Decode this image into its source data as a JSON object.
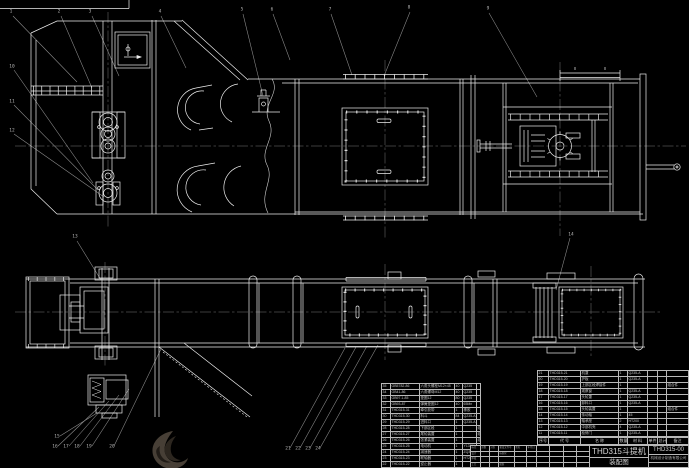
{
  "meta": {
    "background": "#000000",
    "line_color": "#ededed",
    "leader_color": "#8f8f8f",
    "table_line_color": "#b9b9b9",
    "text_color": "#c4c4c4",
    "watermark_color": "#473f36"
  },
  "title_block": {
    "product_title": "THD315斗提机",
    "drawing_type": "装配图",
    "drawing_no": "THD315-00",
    "company": "机械设计制造有限公司",
    "revision_grid": [
      [
        "标记",
        "处数",
        "分区",
        "更改文件号",
        "签名",
        "年月日"
      ],
      [
        "设计",
        "",
        "",
        "标准化",
        "",
        ""
      ],
      [
        "审核",
        "",
        "",
        "",
        "",
        ""
      ],
      [
        "工艺",
        "",
        "",
        "批准",
        "",
        ""
      ]
    ],
    "stage_grid": [
      [
        "",
        "",
        "",
        ""
      ],
      [
        "",
        "",
        "",
        ""
      ],
      [
        "",
        "",
        "",
        ""
      ],
      [
        "",
        "",
        "",
        ""
      ]
    ]
  },
  "bom_right": {
    "header": [
      "序号",
      "代 号",
      "名 称",
      "数量",
      "材 料",
      "单件",
      "总计",
      "备注"
    ],
    "rows": [
      [
        "21",
        "THD315-21",
        "机罩",
        "1",
        "Q235-A",
        "",
        "",
        ""
      ],
      [
        "20",
        "THD315-20",
        "护板",
        "1",
        "Q235-A",
        "",
        "",
        ""
      ],
      [
        "19",
        "THD315-19",
        "上部区段焊接件",
        "1",
        "",
        "",
        "",
        "组合件"
      ],
      [
        "18",
        "THD315-18",
        "观察窗",
        "1",
        "Q235-A",
        "",
        "",
        ""
      ],
      [
        "17",
        "THD315-17",
        "头轮罩",
        "1",
        "Q235-A",
        "",
        "",
        ""
      ],
      [
        "16",
        "THD315-16",
        "卸料口",
        "1",
        "Q235-A",
        "",
        "",
        ""
      ],
      [
        "15",
        "THD315-15",
        "头轮装置",
        "1",
        "",
        "",
        "",
        "组合件"
      ],
      [
        "14",
        "THD315-14",
        "传动轴",
        "1",
        "45",
        "",
        "",
        ""
      ],
      [
        "13",
        "THD315-13",
        "轴承座",
        "2",
        "HT200",
        "",
        "",
        ""
      ],
      [
        "12",
        "THD315-12",
        "中部机壳",
        "4",
        "Q235-A",
        "",
        "",
        ""
      ],
      [
        "11",
        "THD315-11",
        "检修门",
        "1",
        "Q235-A",
        "",
        "",
        ""
      ]
    ]
  },
  "bom_left": {
    "rows": [
      [
        "35",
        "GB5782-86",
        "六角头螺栓M12×45",
        "40",
        "Q235",
        ""
      ],
      [
        "34",
        "GB41-86",
        "六角螺母M12",
        "40",
        "Q235",
        ""
      ],
      [
        "33",
        "GB97.1-85",
        "垫圈12",
        "80",
        "Q235",
        ""
      ],
      [
        "32",
        "GB93-87",
        "弹簧垫圈12",
        "40",
        "65Mn",
        ""
      ],
      [
        "31",
        "THD315-31",
        "牵引胶带",
        "1",
        "橡胶",
        ""
      ],
      [
        "30",
        "THD315-30",
        "料斗",
        "84",
        "Q235-A",
        ""
      ],
      [
        "29",
        "THD315-29",
        "进料口",
        "1",
        "Q235-A",
        ""
      ],
      [
        "28",
        "THD315-28",
        "下部区段",
        "1",
        "",
        "组合件"
      ],
      [
        "27",
        "THD315-27",
        "尾轮装置",
        "1",
        "",
        "组合件"
      ],
      [
        "26",
        "THD315-26",
        "张紧装置",
        "1",
        "",
        "组合件"
      ],
      [
        "25",
        "THD315-25",
        "电动机",
        "1",
        "Y132M-4",
        ""
      ],
      [
        "24",
        "THD315-24",
        "减速器",
        "1",
        "ZQ350",
        ""
      ],
      [
        "23",
        "THD315-23",
        "联轴器",
        "1",
        "HT200",
        ""
      ],
      [
        "22",
        "THD315-22",
        "逆止器",
        "1",
        "",
        ""
      ]
    ]
  },
  "callouts": [
    {
      "x": 11,
      "y": 13,
      "label": "1"
    },
    {
      "x": 59,
      "y": 13,
      "label": "2"
    },
    {
      "x": 90,
      "y": 13,
      "label": "3"
    },
    {
      "x": 160,
      "y": 13,
      "label": "4"
    },
    {
      "x": 242,
      "y": 11,
      "label": "5"
    },
    {
      "x": 272,
      "y": 11,
      "label": "6"
    },
    {
      "x": 330,
      "y": 11,
      "label": "7"
    },
    {
      "x": 409,
      "y": 9,
      "label": "8"
    },
    {
      "x": 488,
      "y": 10,
      "label": "9"
    },
    {
      "x": 12,
      "y": 68,
      "label": "10"
    },
    {
      "x": 12,
      "y": 103,
      "label": "11"
    },
    {
      "x": 12,
      "y": 132,
      "label": "12"
    },
    {
      "x": 75,
      "y": 238,
      "label": "13"
    },
    {
      "x": 571,
      "y": 236,
      "label": "14"
    },
    {
      "x": 57,
      "y": 438,
      "label": "15"
    },
    {
      "x": 55,
      "y": 448,
      "label": "16"
    },
    {
      "x": 66,
      "y": 448,
      "label": "17"
    },
    {
      "x": 77,
      "y": 448,
      "label": "18"
    },
    {
      "x": 89,
      "y": 448,
      "label": "19"
    },
    {
      "x": 112,
      "y": 448,
      "label": "20"
    },
    {
      "x": 288,
      "y": 450,
      "label": "21"
    },
    {
      "x": 298,
      "y": 450,
      "label": "22"
    },
    {
      "x": 308,
      "y": 450,
      "label": "23"
    },
    {
      "x": 318,
      "y": 450,
      "label": "24"
    }
  ]
}
